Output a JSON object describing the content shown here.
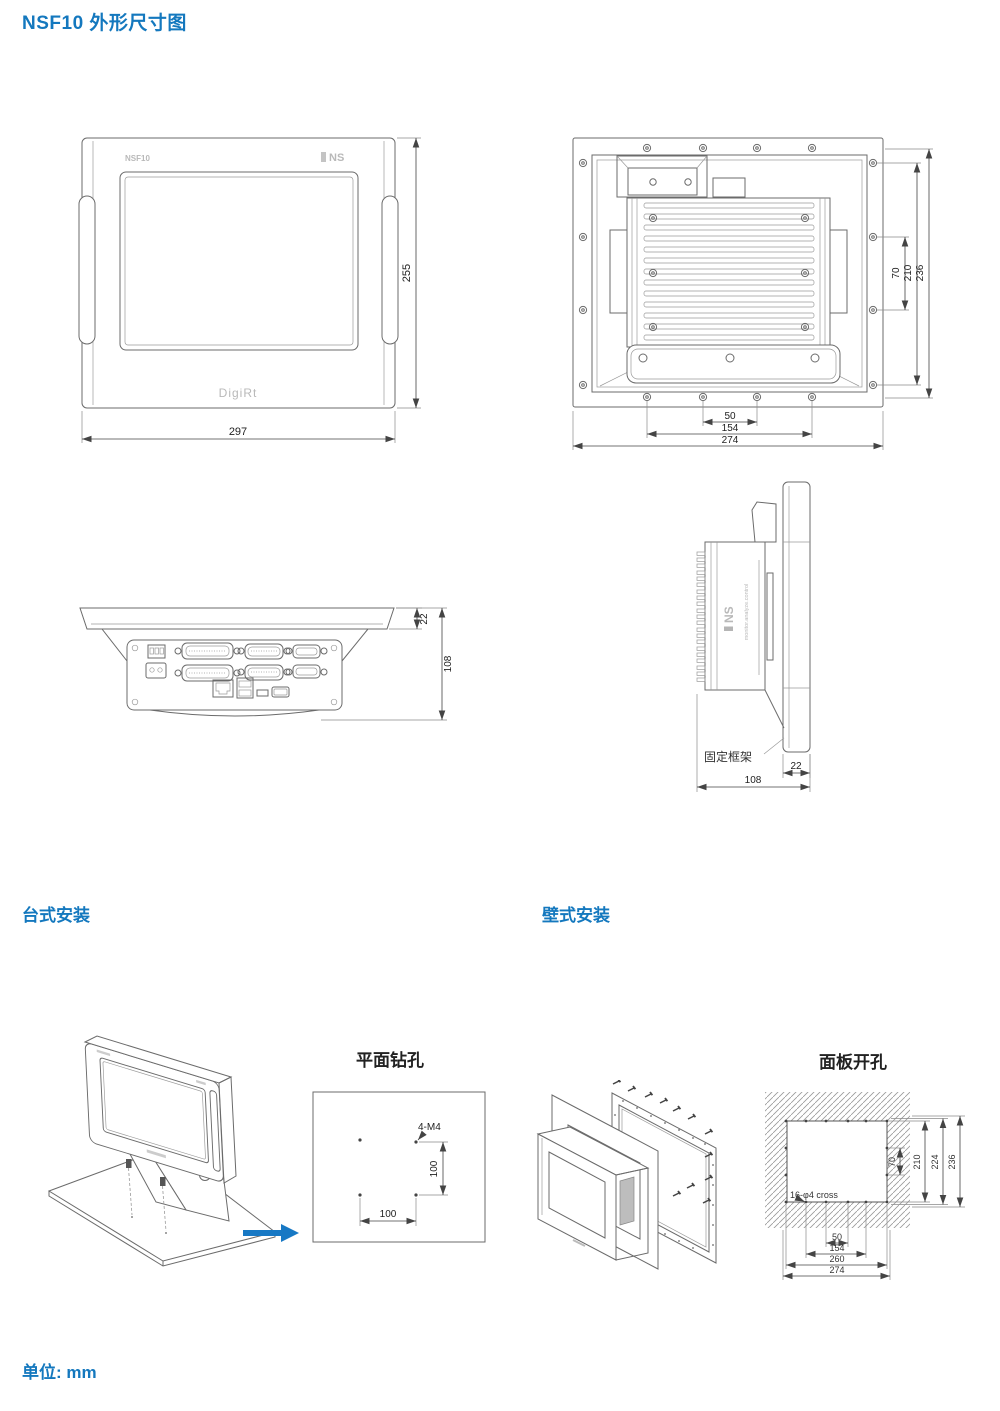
{
  "colors": {
    "accent": "#1478BE",
    "arrow": "#1778C4",
    "drawing_line": "#6B6B6B"
  },
  "page": {
    "title": "NSF10 外形尺寸图",
    "unit_label": "单位: mm"
  },
  "front_view": {
    "model": "NSF10",
    "brand": "NS",
    "wordmark": "DigiRt",
    "dim_height": "255",
    "dim_width": "297"
  },
  "rear_view": {
    "dim_70": "70",
    "dim_210": "210",
    "dim_236": "236",
    "dim_50": "50",
    "dim_154": "154",
    "dim_274": "274"
  },
  "bottom_view": {
    "dim_bezel": "22",
    "dim_depth": "108"
  },
  "side_view": {
    "brand": "NS",
    "tagline": "monitor.analyze.control",
    "frame_label": "固定框架",
    "dim_bezel": "22",
    "dim_depth": "108"
  },
  "desktop_install": {
    "heading": "台式安装",
    "drill_title": "平面钻孔",
    "hole_spec": "4-M4",
    "dim_v": "100",
    "dim_h": "100"
  },
  "wall_install": {
    "heading": "壁式安装",
    "cutout_title": "面板开孔",
    "hole_spec": "16-φ4 cross",
    "dim_70": "70",
    "dim_210": "210",
    "dim_224": "224",
    "dim_236": "236",
    "dim_50": "50",
    "dim_154": "154",
    "dim_260": "260",
    "dim_274": "274"
  }
}
